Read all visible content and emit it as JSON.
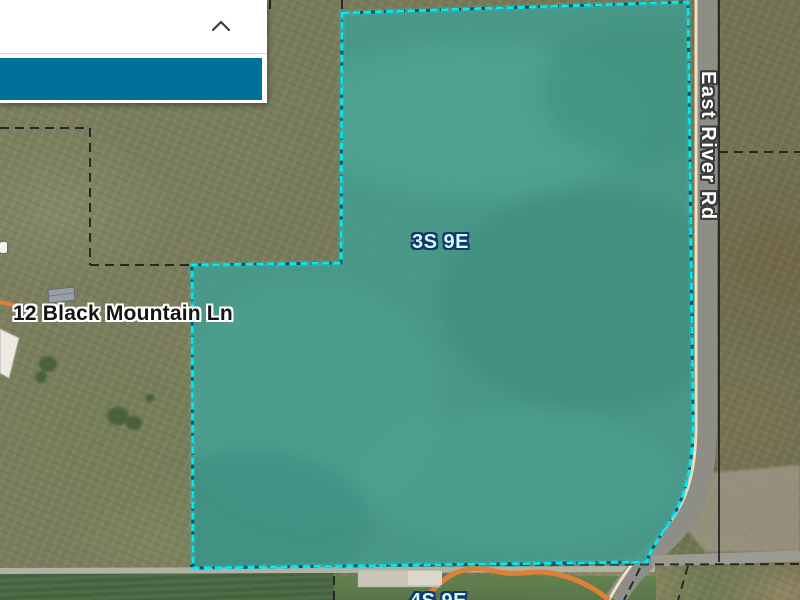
{
  "panel": {
    "collapse_icon": "chevron-up",
    "accent_color": "#00719a"
  },
  "map": {
    "parcel": {
      "fill_color": "#47998a",
      "outline_color": "#06e8f2"
    },
    "labels": {
      "township": "3S 9E",
      "township_south": "4S 9E",
      "address": "12 Black Mountain Ln",
      "road": "East River Rd"
    },
    "colors": {
      "road_surface": "#8e8e86",
      "road_centerline": "#f2e2bf",
      "road_minor": "#dd8038",
      "boundary_lines": "#1f1f1f"
    }
  }
}
